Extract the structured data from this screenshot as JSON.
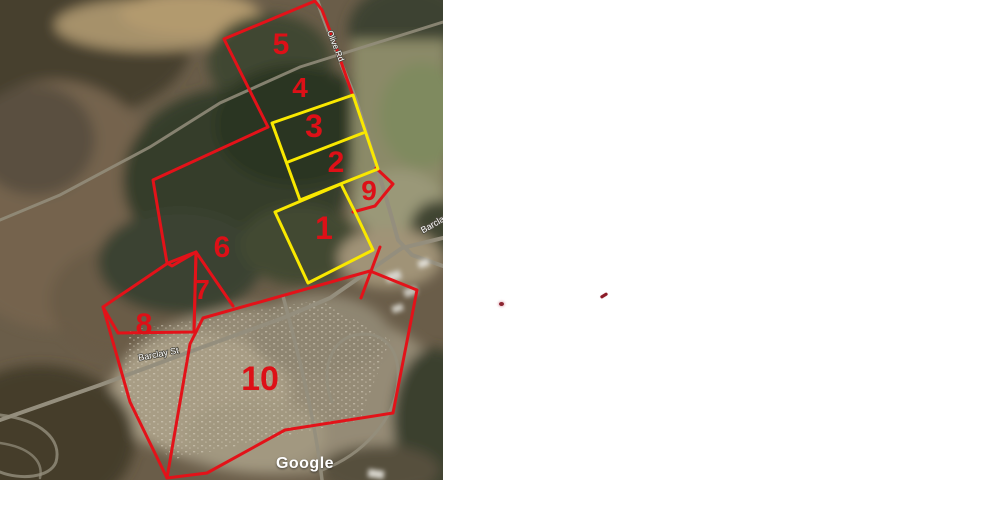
{
  "map": {
    "attribution_label": "Google",
    "parcels": [
      {
        "number": "1"
      },
      {
        "number": "2"
      },
      {
        "number": "3"
      },
      {
        "number": "4"
      },
      {
        "number": "5"
      },
      {
        "number": "6"
      },
      {
        "number": "7"
      },
      {
        "number": "8"
      },
      {
        "number": "9"
      },
      {
        "number": "10"
      }
    ],
    "road_labels": [
      {
        "text": "Olive Rd"
      },
      {
        "text": "Barclay"
      },
      {
        "text": "Barclay St"
      }
    ],
    "colors": {
      "outline_red": "#e31219",
      "outline_yellow": "#f9e800",
      "parcel_number_red": "#dd1017",
      "road_label_white": "#ffffff"
    }
  },
  "annotations": {
    "marks": [
      {
        "name": "small-red-dot"
      },
      {
        "name": "small-red-dash"
      }
    ],
    "mark_color": "#8c1c28"
  }
}
